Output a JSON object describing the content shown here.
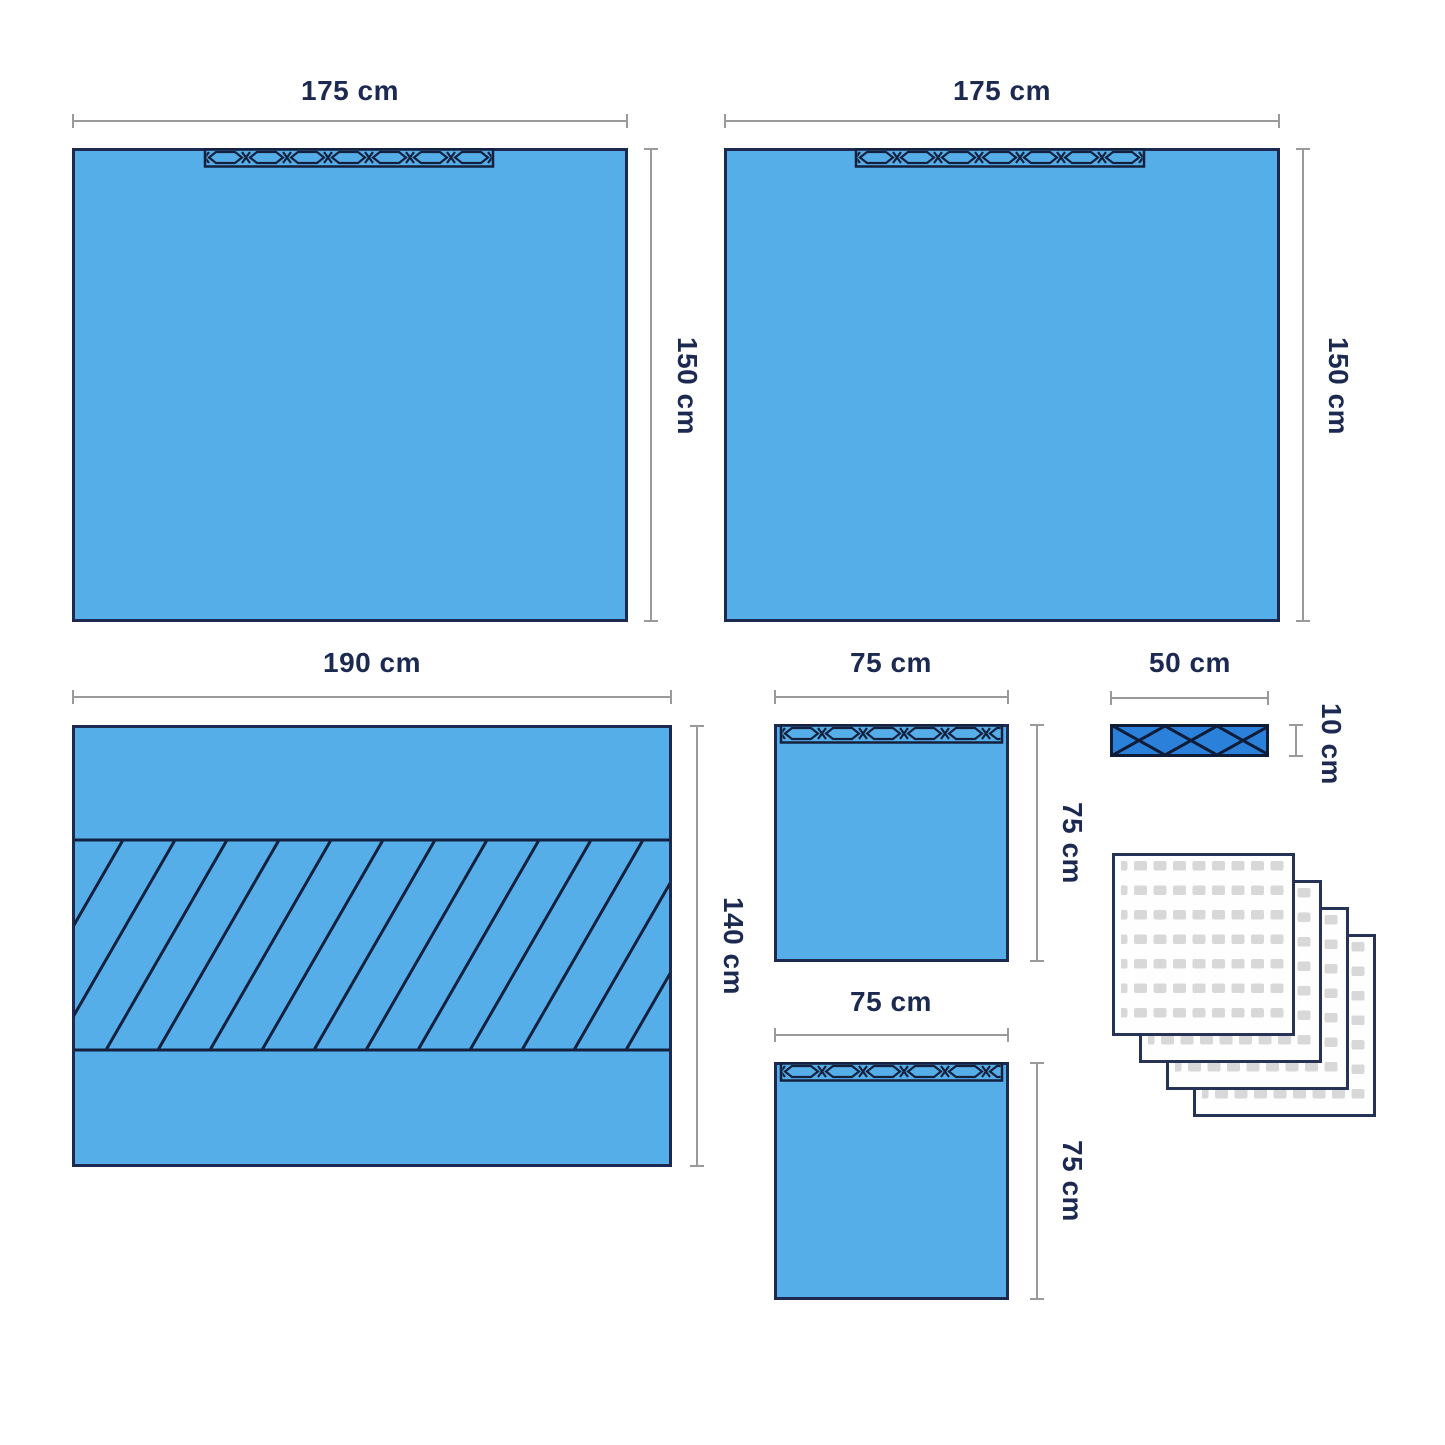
{
  "diagram": {
    "drape_top_left": {
      "width_label": "175 cm",
      "height_label": "150 cm"
    },
    "drape_top_right": {
      "width_label": "175 cm",
      "height_label": "150 cm"
    },
    "drape_fenestrated": {
      "width_label": "190 cm",
      "height_label": "140 cm"
    },
    "drape_small_top": {
      "width_label": "75 cm",
      "height_label": "75 cm"
    },
    "drape_small_bottom": {
      "width_label": "75 cm",
      "height_label": "75 cm"
    },
    "adhesive_strip": {
      "width_label": "50 cm",
      "height_label": "10 cm"
    },
    "towel_stack": {
      "sheet_count": 4
    }
  },
  "colors": {
    "drape_fill": "#56aee8",
    "strip_fill": "#2b80d9",
    "outline_navy": "#1c2a52",
    "dimension_gray": "#9a9a9a",
    "label_navy": "#1c2a52",
    "towel_dot_gray": "#d8d8d8",
    "towel_fill": "#fefefe"
  }
}
